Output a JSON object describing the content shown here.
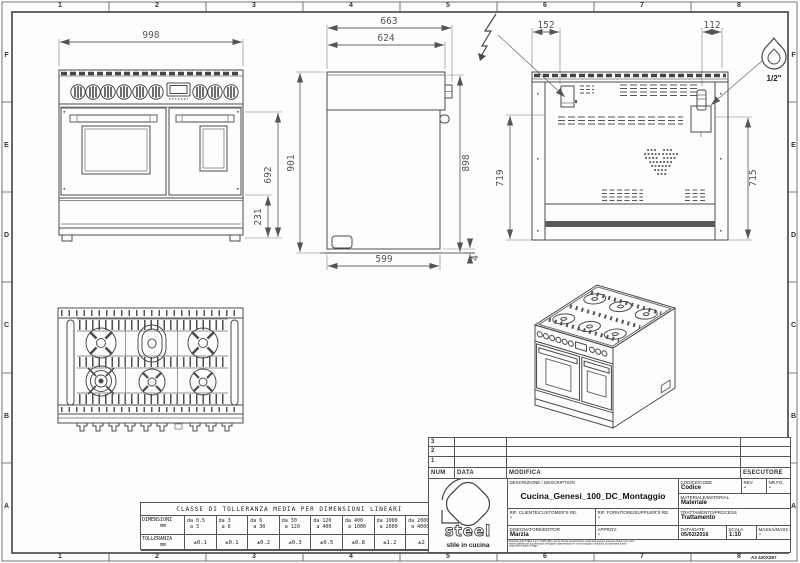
{
  "frame": {
    "columns": [
      "1",
      "2",
      "3",
      "4",
      "5",
      "6",
      "7",
      "8"
    ],
    "rows": [
      "F",
      "E",
      "D",
      "C",
      "B",
      "A"
    ],
    "sheet_format": "A3 420X297"
  },
  "dimensions": {
    "front": {
      "width": "998",
      "oven_height": "692",
      "base_height": "231"
    },
    "side": {
      "depth_total": "663",
      "depth_top": "624",
      "height_overall": "901",
      "height_body": "898",
      "depth_base": "599",
      "gap": "4"
    },
    "rear": {
      "elec_offset": "152",
      "gas_offset": "112",
      "height_left": "719",
      "height_right": "715"
    }
  },
  "symbols": {
    "gas_connection_size": "1/2\""
  },
  "tolerance_table": {
    "title": "CLASSE DI TOLLERANZA MEDIA PER DIMENSIONI LINEARI",
    "dim_label": "DIMENSIONI",
    "dim_unit": "mm",
    "tol_label": "TOLLERANZA",
    "tol_unit": "mm",
    "ranges": [
      {
        "from": "da 0.5",
        "to": "a 3"
      },
      {
        "from": "da 3",
        "to": "a 6"
      },
      {
        "from": "da 6",
        "to": "a 30"
      },
      {
        "from": "da 30",
        "to": "a 120"
      },
      {
        "from": "da 120",
        "to": "a 400"
      },
      {
        "from": "da 400",
        "to": "a 1000"
      },
      {
        "from": "da 1000",
        "to": "a 2000"
      },
      {
        "from": "da 2000",
        "to": "a 4000"
      }
    ],
    "tolerances": [
      "±0.1",
      "±0.1",
      "±0.2",
      "±0.3",
      "±0.5",
      "±0.8",
      "±1.2",
      "±2"
    ]
  },
  "title_block": {
    "revision_rows": [
      "3",
      "2",
      "1"
    ],
    "num_header": "NUM",
    "data_header": "DATA",
    "modifica_header": "MODIFICA",
    "esecutore_header": "ESECUTORE",
    "description_label": "DESCRIZIONE / DESCRIPTION",
    "description": "Cucina_Genesi_100_DC_Montaggio",
    "code_label": "CODICE/CODE",
    "code": "Codice",
    "rev_label": "REV.",
    "rev": "-",
    "sheet_label": "NR.FG.",
    "sheet": "-",
    "material_label": "MATERIALE/MATERIAL",
    "material": "Materiale",
    "customer_ref_label": "RIF. CLIENTE/CUSTOMER'S RE.",
    "customer_ref": "-",
    "supplier_ref_label": "RIF. FORNITORE/SUPPLIER'S RE.",
    "supplier_ref": "-",
    "process_label": "TRATTAMENTO/PROCESS",
    "process": "Trattamento",
    "editor_label": "DISEGNATORE/EDITOR",
    "editor": "Marzia",
    "approv_label": "APPROV.",
    "approv": "-",
    "date_label": "DATA/DATE",
    "date": "05/02/2016",
    "scale_label": "SCALA",
    "scale": "1:10",
    "mass_label": "MASSA/MASS Kg",
    "mass": "-",
    "logo_text": "steel",
    "logo_tagline": "stile in cucina",
    "disclaimer_1": "Proprieta' dello STEEL S.p.A. CARPI (MO). Senza formale autorizzazione scritta della stessa il presente disegno non potra'",
    "disclaimer_2": "essere utilizzato per la costruzione dell'oggetto rappresentato ne' venire divulgato o riprodotto, la proprietaria tutela i",
    "disclaimer_3": "propri diritti a rigore di legge."
  }
}
